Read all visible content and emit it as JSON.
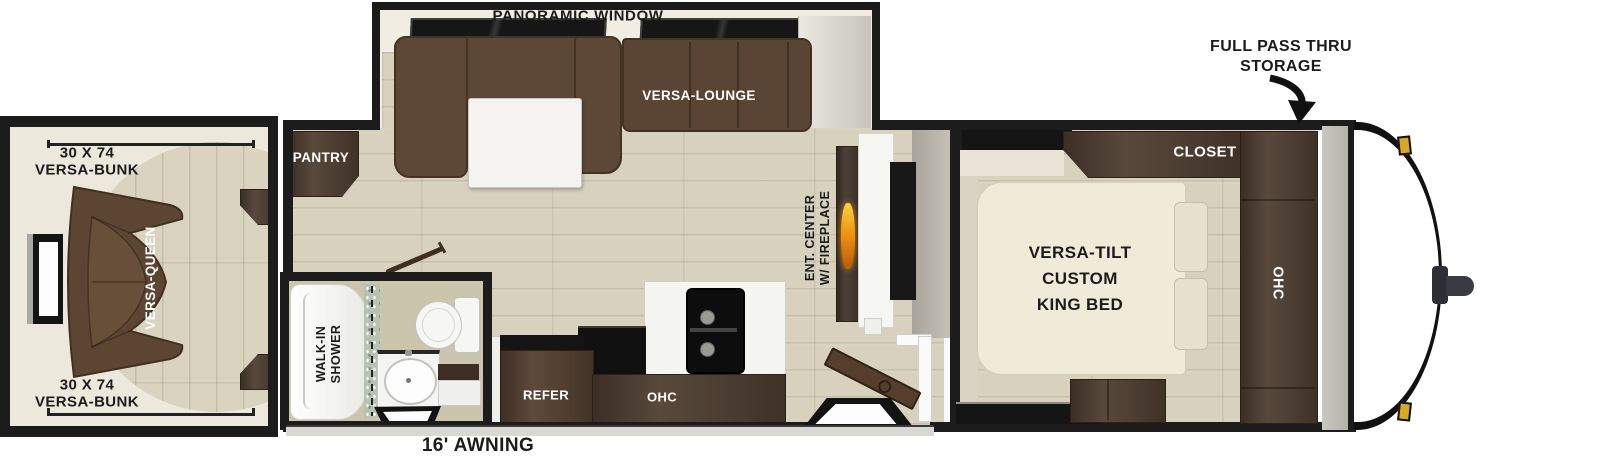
{
  "slideout": {
    "window_label": "PANORAMIC WINDOW",
    "lounge_label": "VERSA-LOUNGE"
  },
  "front_storage": {
    "label_line1": "FULL PASS THRU",
    "label_line2": "STORAGE"
  },
  "bedroom": {
    "closet_label": "CLOSET",
    "bed_line1": "VERSA-TILT",
    "bed_line2": "CUSTOM",
    "bed_line3": "KING BED",
    "ohc_label": "OHC"
  },
  "bunk_room": {
    "top_bunk_line1": "30 X 74",
    "top_bunk_line2": "VERSA-BUNK",
    "bottom_bunk_line1": "30 X 74",
    "bottom_bunk_line2": "VERSA-BUNK",
    "sofa_label": "VERSA-QUEEN"
  },
  "kitchen": {
    "pantry_label": "PANTRY",
    "refer_label": "REFER",
    "ohc_label": "OHC"
  },
  "bathroom": {
    "shower_line1": "WALK-IN",
    "shower_line2": "SHOWER"
  },
  "living": {
    "ent_center_line1": "ENT. CENTER",
    "ent_center_line2": "W/ FIREPLACE"
  },
  "exterior": {
    "awning_label": "16' AWNING"
  },
  "colors": {
    "wall": "#1c1c1c",
    "wood_floor": "#d7d1be",
    "cabinet_brown": "#4c3b2e",
    "sofa_brown": "#5d4736",
    "bed_cream": "#f0ead8",
    "flame_orange": "#ef9414",
    "gold_marker": "#d8a928",
    "awning_gray": "#d9d8d4"
  }
}
